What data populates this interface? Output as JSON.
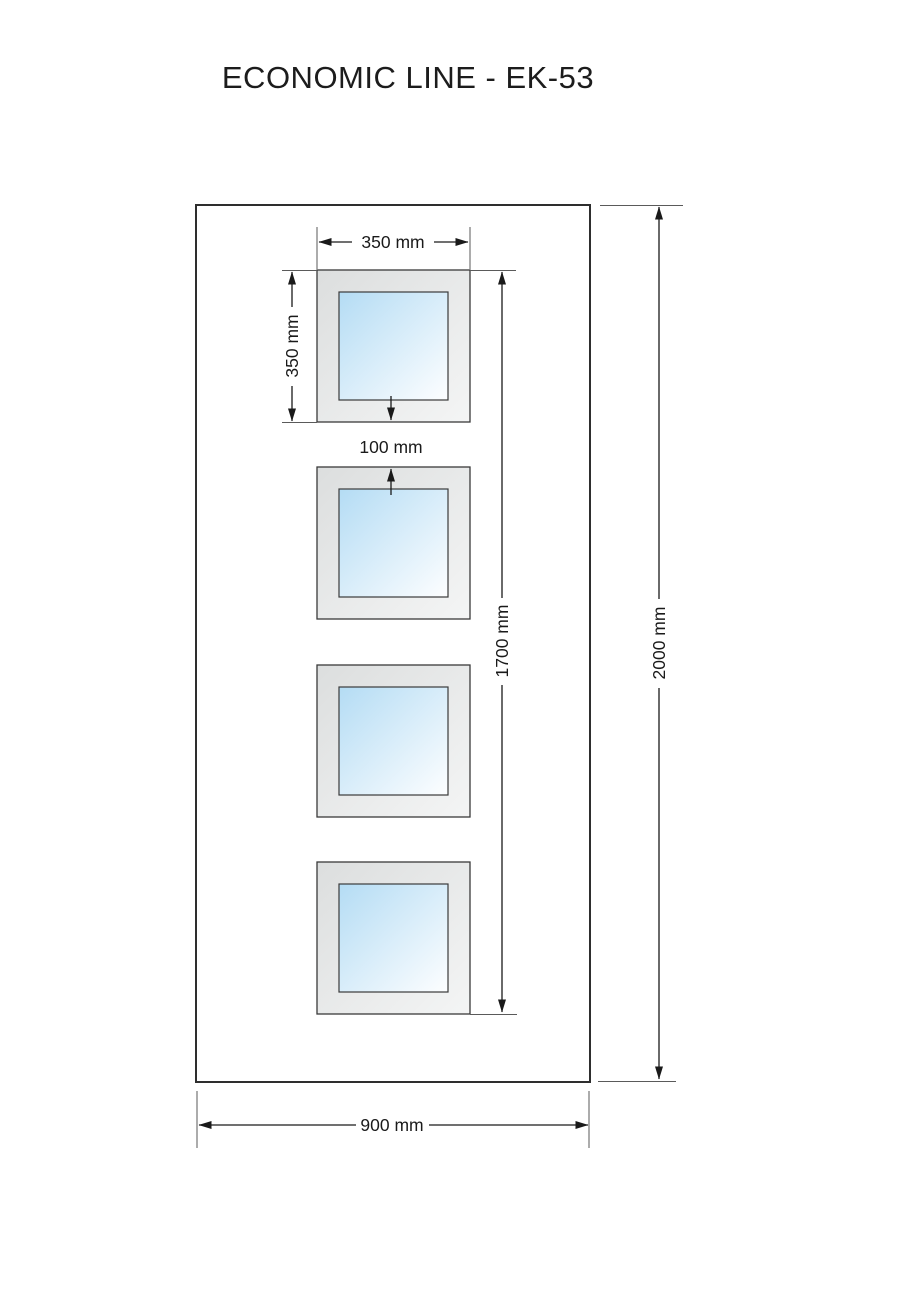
{
  "title": "ECONOMIC LINE - EK-53",
  "dimensions": {
    "window_width": "350 mm",
    "window_height": "350 mm",
    "window_gap": "100 mm",
    "glazing_span": "1700 mm",
    "door_height": "2000 mm",
    "door_width": "900 mm"
  },
  "windows": {
    "count": 4
  },
  "colors": {
    "glass_start": "#b4dcf4",
    "glass_end": "#fdfeff",
    "frame_start": "#dcdede",
    "frame_end": "#f4f5f5",
    "line": "#1a1a1a"
  }
}
